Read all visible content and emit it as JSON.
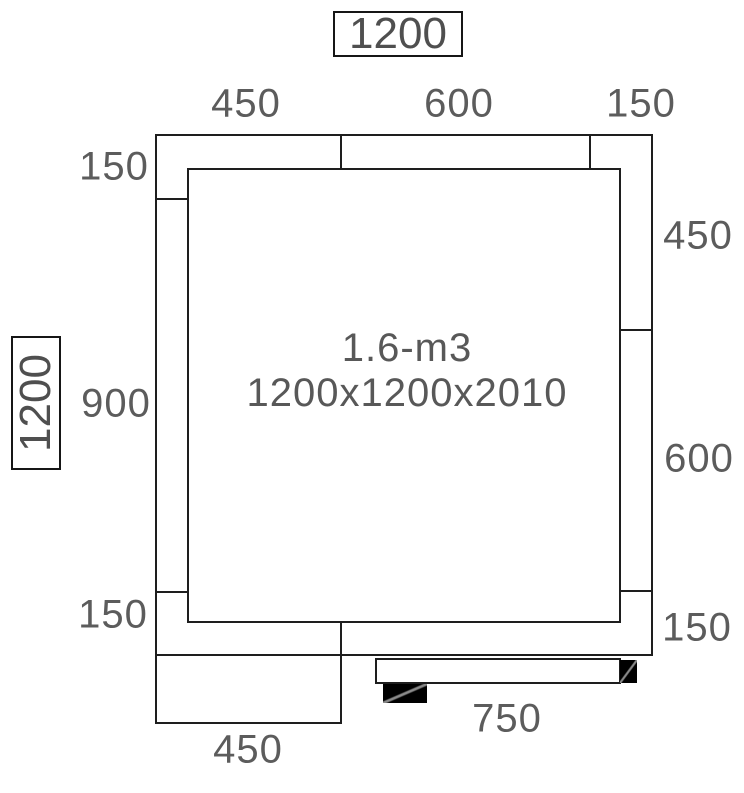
{
  "drawing": {
    "title": "cold-room-floor-plan",
    "center_label": {
      "line1": "1.6-m3",
      "line2": "1200x1200x2010"
    },
    "overall": {
      "width_box": "1200",
      "depth_box": "1200"
    },
    "dims": {
      "top": [
        "450",
        "600",
        "150"
      ],
      "left": [
        "150",
        "900",
        "150"
      ],
      "right": [
        "450",
        "600",
        "150"
      ],
      "bottom": [
        "450",
        "750"
      ]
    },
    "colors": {
      "background": "#ffffff",
      "line": "#1e1e1e",
      "label": "#5c5c5c",
      "hardware_block": "#000000",
      "hardware_diagonal": "#8a8a8a"
    }
  }
}
